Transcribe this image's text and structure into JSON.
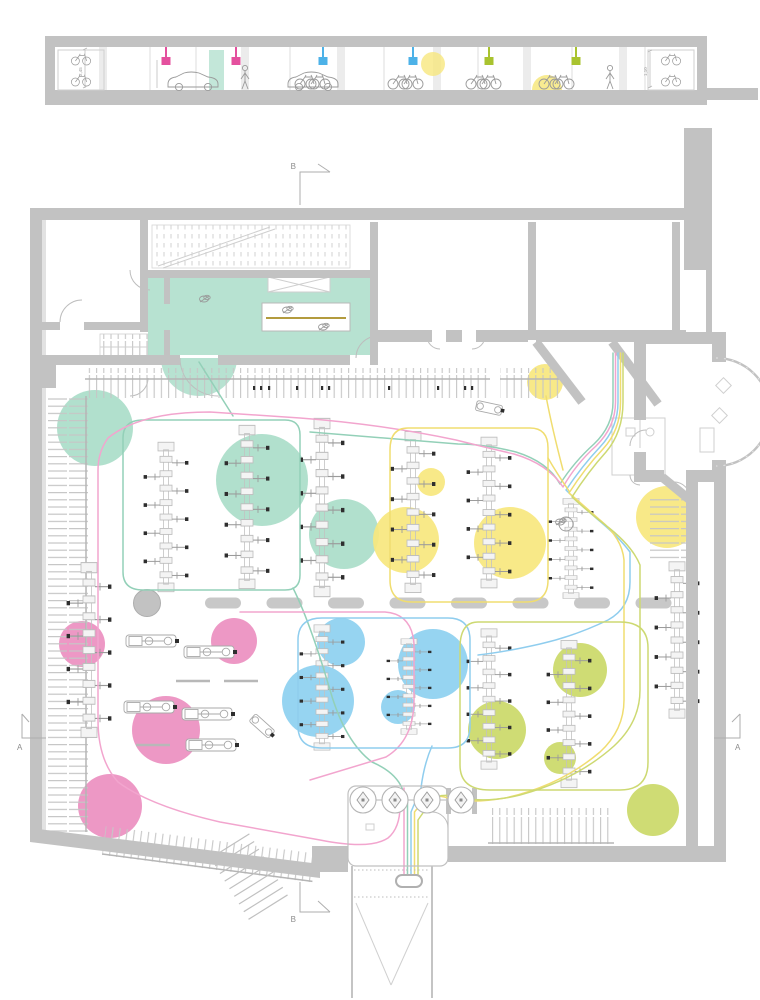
{
  "colors": {
    "wall": "#c2c2c2",
    "wall_light": "#e2e2e2",
    "line": "#b9b9b9",
    "teal": "#aaddc9",
    "teal_line": "#93d0b8",
    "yellow": "#f7e77e",
    "yellow_line": "#f0dd70",
    "pink": "#ec8fc0",
    "pink_line": "#f2a5ce",
    "blue": "#8dd0f0",
    "blue_line": "#8fcdee",
    "lime": "#cbd968",
    "lime_line": "#cdd972",
    "pendant_pink": "#e4509e",
    "pendant_blue": "#4db2e8",
    "pendant_lime": "#a9c32f",
    "desk_accent": "#b39b3e",
    "black_dot": "#2e2e2e",
    "furniture": "#c8c8c8"
  },
  "section": {
    "dim_left": "2,45",
    "dim_right": "1,10",
    "lights": [
      {
        "color": "pink"
      },
      {
        "color": "pink"
      },
      {
        "color": "blue"
      },
      {
        "color": "blue"
      },
      {
        "color": "lime"
      },
      {
        "color": "lime"
      }
    ]
  },
  "plan": {
    "markers": {
      "top": "B",
      "bottom": "B",
      "left": "A",
      "right": "A"
    }
  },
  "zones": [
    {
      "name": "teal"
    },
    {
      "name": "yellow"
    },
    {
      "name": "pink"
    },
    {
      "name": "blue"
    },
    {
      "name": "lime"
    }
  ]
}
